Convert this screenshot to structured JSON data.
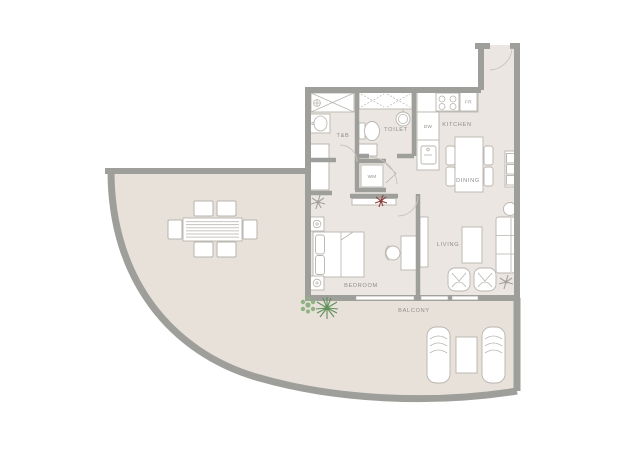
{
  "plan_title": "Apartment floor plan",
  "colors": {
    "wall": "#9e9e9a",
    "floor_indoor": "#ebe6e1",
    "floor_outdoor": "#e7e1d9",
    "furniture_stroke": "#b8b4ae",
    "label": "#8f8d8a",
    "plant_green_light": "#8fb283",
    "plant_green_dark": "#5f8f5b",
    "plant_red": "#8d3f3c",
    "plant_grey": "#a3a19d"
  },
  "rooms": {
    "tnb": "T&B",
    "toilet": "TOILET",
    "kitchen": "KITCHEN",
    "dining": "DINING",
    "living": "LIVING",
    "bedroom": "BEDROOM",
    "balcony": "BALCONY"
  },
  "appliances": {
    "dw": "DW",
    "fr": "FR",
    "wm": "WM"
  }
}
